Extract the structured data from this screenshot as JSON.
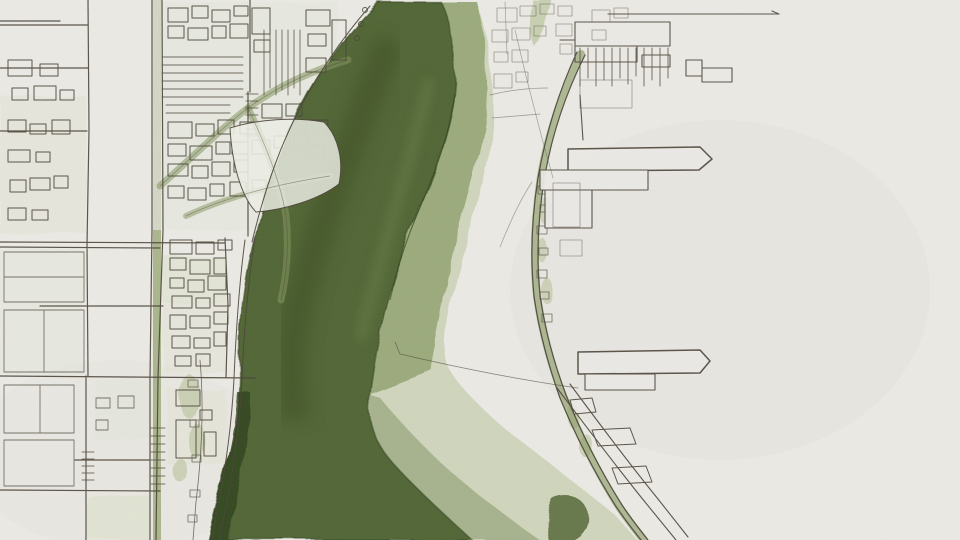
{
  "artwork": {
    "kind": "hand-drawn ink and watercolor city map",
    "subject": "river channel flowing through a city grid toward a delta, piers on the east shore"
  },
  "palette": {
    "paper": "#ebeae5",
    "paper_shade": "#e4e3dc",
    "pond": "#edefe6",
    "ink": "#4e463a",
    "ink_faint": "#7a7264",
    "river_dark": "#4d6231",
    "river_edge": "#2e3f1c",
    "river_vein": "#3c5023",
    "river_light_vein": "#6c8049",
    "river_mid": "#93a371",
    "wash_light": "#cdd2b8",
    "wash_fan": "#8b9a6e",
    "tint_pale": "#dfe3d0",
    "street_green": "#8fa168",
    "bank_green": "#b9c49c",
    "road_green": "#84965e",
    "fold_line": "#33441f"
  },
  "regions": {
    "river_channel": "dark river channel",
    "inner_bank_wash": "light inner-bank wash",
    "delta_fan": "delta wash fan",
    "west_city_grid": "west city street grid",
    "shore_ribbon": "riverfront building ribbon",
    "east_shore_road": "east shoreline road",
    "piers": "piers and docks",
    "northeast_docks": "northeast dock cluster"
  }
}
